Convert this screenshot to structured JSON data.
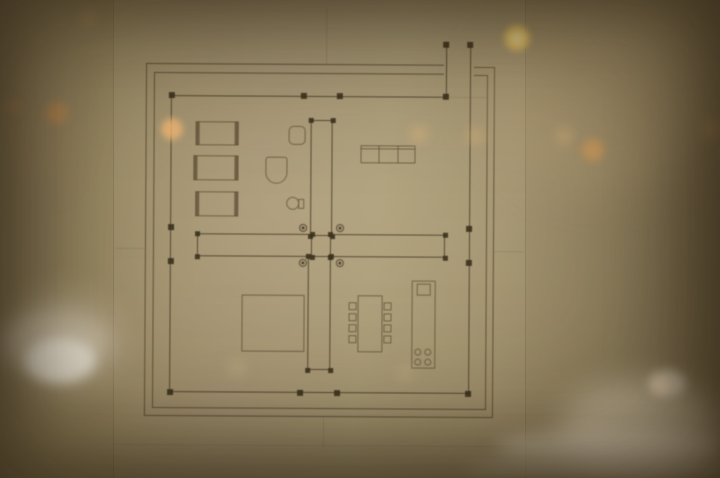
{
  "scene": {
    "subject": "architectural floor plan drawing framed behind reflective glass",
    "colors": {
      "frame": "rgba(78,64,42,0.82)",
      "wall": "rgba(62,52,32,0.85)",
      "column": "rgba(52,43,24,0.92)",
      "furn": "rgba(92,78,53,0.80)",
      "guide": "rgba(104,90,64,0.50)"
    }
  },
  "plan": {
    "frame": [
      {
        "type": "hline",
        "name": "frame-outer-top-left",
        "x": 145,
        "y": 64,
        "w": 298,
        "t": 1.4
      },
      {
        "type": "hline",
        "name": "frame-outer-top-right",
        "x": 473,
        "y": 66,
        "w": 21,
        "t": 1.4
      },
      {
        "type": "vline",
        "name": "frame-outer-right",
        "x": 493,
        "y": 66,
        "h": 351,
        "t": 1.4
      },
      {
        "type": "hline",
        "name": "frame-outer-bottom",
        "x": 145,
        "y": 416,
        "w": 349,
        "t": 1.4
      },
      {
        "type": "vline",
        "name": "frame-outer-left",
        "x": 145,
        "y": 64,
        "h": 353,
        "t": 1.4
      },
      {
        "type": "hline",
        "name": "frame-inner-top-left",
        "x": 153,
        "y": 73,
        "w": 290
      },
      {
        "type": "hline",
        "name": "frame-inner-top-right",
        "x": 473,
        "y": 74,
        "w": 13
      },
      {
        "type": "vline",
        "name": "frame-inner-right",
        "x": 486,
        "y": 74,
        "h": 335
      },
      {
        "type": "hline",
        "name": "frame-inner-bottom",
        "x": 153,
        "y": 408,
        "w": 334
      },
      {
        "type": "vline",
        "name": "frame-inner-left",
        "x": 153,
        "y": 73,
        "h": 336
      }
    ],
    "guides": [
      {
        "type": "vline",
        "name": "center-axis-guide-top",
        "x": 325,
        "y": 8,
        "h": 56,
        "t": 1,
        "o": 0.55
      },
      {
        "type": "vline",
        "name": "center-axis-guide-bottom",
        "x": 324,
        "y": 417,
        "h": 31,
        "t": 1,
        "o": 0.5
      },
      {
        "type": "hline",
        "name": "center-axis-guide-left",
        "x": 115,
        "y": 249,
        "w": 31,
        "t": 1,
        "o": 0.5
      },
      {
        "type": "hline",
        "name": "center-axis-guide-right",
        "x": 494,
        "y": 250,
        "w": 30,
        "t": 1,
        "o": 0.5
      },
      {
        "type": "hline",
        "name": "top-wall-guide-extension",
        "x": 448,
        "y": 96,
        "w": 38,
        "t": 1,
        "o": 0.4
      },
      {
        "type": "hline",
        "name": "sheet-bottom-edge",
        "x": 113,
        "y": 445,
        "w": 411,
        "t": 1,
        "o": 0.35
      }
    ],
    "walls": [
      {
        "type": "hline",
        "name": "top-exterior-wall",
        "x": 171,
        "y": 95.5,
        "w": 275,
        "t": 1.3
      },
      {
        "type": "vline",
        "name": "left-exterior-wall",
        "x": 170,
        "y": 96,
        "h": 297,
        "t": 1.3
      },
      {
        "type": "hline",
        "name": "bottom-exterior-wall",
        "x": 171,
        "y": 392,
        "w": 298,
        "t": 1.3
      },
      {
        "type": "vline",
        "name": "right-exterior-wall",
        "x": 469,
        "y": 44,
        "h": 349,
        "t": 1.3
      },
      {
        "type": "vline",
        "name": "court-extension-wall",
        "x": 445,
        "y": 44,
        "h": 52,
        "t": 1.3
      }
    ],
    "wall_boxes": [
      {
        "type": "rect",
        "name": "pinwheel-wall-north",
        "x": 310,
        "y": 120,
        "w": 22,
        "h": 116
      },
      {
        "type": "rect",
        "name": "pinwheel-wall-south",
        "x": 308,
        "y": 256,
        "w": 23,
        "h": 114
      },
      {
        "type": "rect",
        "name": "pinwheel-wall-west",
        "x": 197,
        "y": 234,
        "w": 115,
        "h": 23
      },
      {
        "type": "rect",
        "name": "pinwheel-wall-east",
        "x": 330,
        "y": 234,
        "w": 115,
        "h": 23
      }
    ],
    "square_columns": [
      {
        "name": "column",
        "x": 171,
        "y": 96,
        "s": 6
      },
      {
        "name": "column",
        "x": 303,
        "y": 96,
        "s": 6
      },
      {
        "name": "column",
        "x": 339,
        "y": 96,
        "s": 6
      },
      {
        "name": "column",
        "x": 445,
        "y": 96,
        "s": 6
      },
      {
        "name": "column",
        "x": 171,
        "y": 228,
        "s": 6
      },
      {
        "name": "column",
        "x": 171,
        "y": 262,
        "s": 6
      },
      {
        "name": "column",
        "x": 171,
        "y": 393,
        "s": 6
      },
      {
        "name": "column",
        "x": 469,
        "y": 228,
        "s": 6
      },
      {
        "name": "column",
        "x": 469,
        "y": 262,
        "s": 6
      },
      {
        "name": "column",
        "x": 469,
        "y": 393,
        "s": 6
      },
      {
        "name": "column",
        "x": 301,
        "y": 393,
        "s": 6
      },
      {
        "name": "column",
        "x": 338,
        "y": 393,
        "s": 6
      },
      {
        "name": "column",
        "x": 445,
        "y": 44,
        "s": 6
      },
      {
        "name": "column",
        "x": 469,
        "y": 44,
        "s": 6
      },
      {
        "name": "wall-end-pier",
        "x": 310,
        "y": 120,
        "s": 5
      },
      {
        "name": "wall-end-pier",
        "x": 332,
        "y": 120,
        "s": 5
      },
      {
        "name": "wall-end-pier",
        "x": 310,
        "y": 236,
        "s": 5
      },
      {
        "name": "wall-end-pier",
        "x": 332,
        "y": 236,
        "s": 5
      },
      {
        "name": "wall-end-pier",
        "x": 308,
        "y": 256,
        "s": 5
      },
      {
        "name": "wall-end-pier",
        "x": 331,
        "y": 256,
        "s": 5
      },
      {
        "name": "wall-end-pier",
        "x": 308,
        "y": 370,
        "s": 5
      },
      {
        "name": "wall-end-pier",
        "x": 331,
        "y": 370,
        "s": 5
      },
      {
        "name": "wall-end-pier",
        "x": 197,
        "y": 234,
        "s": 5
      },
      {
        "name": "wall-end-pier",
        "x": 312,
        "y": 234,
        "s": 5
      },
      {
        "name": "wall-end-pier",
        "x": 197,
        "y": 257,
        "s": 5
      },
      {
        "name": "wall-end-pier",
        "x": 312,
        "y": 257,
        "s": 5
      },
      {
        "name": "wall-end-pier",
        "x": 330,
        "y": 234,
        "s": 5
      },
      {
        "name": "wall-end-pier",
        "x": 445,
        "y": 234,
        "s": 5
      },
      {
        "name": "wall-end-pier",
        "x": 330,
        "y": 257,
        "s": 5
      },
      {
        "name": "wall-end-pier",
        "x": 445,
        "y": 257,
        "s": 5
      }
    ],
    "round_columns": [
      {
        "name": "round-column",
        "x": 303,
        "y": 228
      },
      {
        "name": "round-column",
        "x": 340,
        "y": 228
      },
      {
        "name": "round-column",
        "x": 303,
        "y": 263
      },
      {
        "name": "round-column",
        "x": 340,
        "y": 263
      }
    ],
    "furniture": [
      {
        "type": "rect",
        "name": "bed-1",
        "x": 195,
        "y": 122,
        "w": 43,
        "h": 24
      },
      {
        "type": "bar",
        "name": "bed-1-headboard",
        "x": 195,
        "y": 122,
        "w": 4,
        "h": 24
      },
      {
        "type": "bar",
        "name": "bed-1-footboard",
        "x": 234,
        "y": 122,
        "w": 4,
        "h": 24
      },
      {
        "type": "rect",
        "name": "bed-2",
        "x": 193,
        "y": 156,
        "w": 45,
        "h": 25
      },
      {
        "type": "bar",
        "name": "bed-2-headboard",
        "x": 193,
        "y": 156,
        "w": 4,
        "h": 25
      },
      {
        "type": "bar",
        "name": "bed-2-footboard",
        "x": 234,
        "y": 156,
        "w": 4,
        "h": 25
      },
      {
        "type": "rect",
        "name": "bed-3",
        "x": 195,
        "y": 192,
        "w": 43,
        "h": 25
      },
      {
        "type": "bar",
        "name": "bed-3-headboard",
        "x": 195,
        "y": 192,
        "w": 4,
        "h": 25
      },
      {
        "type": "bar",
        "name": "bed-3-footboard",
        "x": 234,
        "y": 192,
        "w": 4,
        "h": 25
      },
      {
        "type": "basin",
        "name": "washbasin",
        "x": 288,
        "y": 126,
        "w": 17,
        "h": 19
      },
      {
        "type": "tub",
        "name": "bathtub",
        "x": 265,
        "y": 157,
        "w": 22,
        "h": 27
      },
      {
        "type": "circle",
        "name": "toilet-bowl",
        "x": 286,
        "y": 197,
        "d": 13
      },
      {
        "type": "rect",
        "name": "toilet-tank",
        "x": 298,
        "y": 199,
        "w": 6,
        "h": 10
      },
      {
        "type": "rect",
        "name": "kitchen-counter",
        "x": 360,
        "y": 145,
        "w": 55,
        "h": 18
      },
      {
        "type": "hline",
        "name": "kitchen-counter-edge",
        "x": 360,
        "y": 148,
        "w": 55,
        "t": 1
      },
      {
        "type": "vline",
        "name": "kitchen-counter-divider",
        "x": 378,
        "y": 145,
        "h": 18,
        "t": 1
      },
      {
        "type": "vline",
        "name": "kitchen-counter-divider",
        "x": 397,
        "y": 145,
        "h": 18,
        "t": 1
      },
      {
        "type": "rect",
        "name": "patio-square",
        "x": 242,
        "y": 295,
        "w": 63,
        "h": 57
      },
      {
        "type": "rect",
        "name": "dining-table",
        "x": 358,
        "y": 295,
        "w": 25,
        "h": 57
      },
      {
        "type": "rect",
        "name": "chair",
        "x": 349,
        "y": 302,
        "w": 8,
        "h": 8
      },
      {
        "type": "rect",
        "name": "chair",
        "x": 349,
        "y": 313,
        "w": 8,
        "h": 8
      },
      {
        "type": "rect",
        "name": "chair",
        "x": 349,
        "y": 324,
        "w": 8,
        "h": 8
      },
      {
        "type": "rect",
        "name": "chair",
        "x": 349,
        "y": 335,
        "w": 8,
        "h": 8
      },
      {
        "type": "rect",
        "name": "chair",
        "x": 384,
        "y": 302,
        "w": 8,
        "h": 8
      },
      {
        "type": "rect",
        "name": "chair",
        "x": 384,
        "y": 313,
        "w": 8,
        "h": 8
      },
      {
        "type": "rect",
        "name": "chair",
        "x": 384,
        "y": 324,
        "w": 8,
        "h": 8
      },
      {
        "type": "rect",
        "name": "chair",
        "x": 384,
        "y": 335,
        "w": 8,
        "h": 8
      },
      {
        "type": "rect",
        "name": "kitchen-island",
        "x": 412,
        "y": 280,
        "w": 24,
        "h": 88
      },
      {
        "type": "rect",
        "name": "island-sink",
        "x": 417,
        "y": 283,
        "w": 14,
        "h": 12
      },
      {
        "type": "circle",
        "name": "stove-burner",
        "x": 415,
        "y": 348,
        "d": 7
      },
      {
        "type": "circle",
        "name": "stove-burner",
        "x": 425,
        "y": 348,
        "d": 7
      },
      {
        "type": "circle",
        "name": "stove-burner",
        "x": 415,
        "y": 358,
        "d": 7
      },
      {
        "type": "circle",
        "name": "stove-burner",
        "x": 425,
        "y": 358,
        "d": 7
      }
    ]
  },
  "photo": {
    "bokeh": [
      {
        "name": "bokeh-light",
        "cx": 57,
        "cy": 113,
        "r": 13,
        "color": "rgba(216,140,70,0.50)",
        "blur": 4
      },
      {
        "name": "bokeh-light",
        "cx": 14,
        "cy": 106,
        "r": 9,
        "color": "rgba(200,130,70,0.35)",
        "blur": 4
      },
      {
        "name": "bokeh-light",
        "cx": 88,
        "cy": 18,
        "r": 10,
        "color": "rgba(210,160,100,0.30)",
        "blur": 5
      },
      {
        "name": "bokeh-light",
        "cx": 172,
        "cy": 129,
        "r": 13,
        "color": "rgba(245,185,118,0.80)",
        "blur": 3
      },
      {
        "name": "bokeh-light",
        "cx": 517,
        "cy": 38,
        "r": 15,
        "color": "rgba(244,205,96,0.95)",
        "blur": 3,
        "core": "rgba(253,240,180,0.95)"
      },
      {
        "name": "bokeh-light",
        "cx": 593,
        "cy": 150,
        "r": 13,
        "color": "rgba(224,152,72,0.60)",
        "blur": 4
      },
      {
        "name": "bokeh-light",
        "cx": 712,
        "cy": 129,
        "r": 11,
        "color": "rgba(200,140,80,0.40)",
        "blur": 5
      },
      {
        "name": "bokeh-light",
        "cx": 419,
        "cy": 134,
        "r": 11,
        "color": "rgba(228,184,124,0.38)",
        "blur": 5
      },
      {
        "name": "bokeh-light",
        "cx": 475,
        "cy": 136,
        "r": 11,
        "color": "rgba(228,184,124,0.32)",
        "blur": 5
      },
      {
        "name": "bokeh-light",
        "cx": 564,
        "cy": 136,
        "r": 11,
        "color": "rgba(228,184,124,0.32)",
        "blur": 5
      },
      {
        "name": "bokeh-light",
        "cx": 661,
        "cy": 386,
        "r": 10,
        "color": "rgba(230,160,90,0.50)",
        "blur": 4
      },
      {
        "name": "bokeh-light",
        "cx": 237,
        "cy": 368,
        "r": 11,
        "color": "rgba(222,192,142,0.28)",
        "blur": 6
      },
      {
        "name": "bokeh-light",
        "cx": 405,
        "cy": 373,
        "r": 10,
        "color": "rgba(222,192,142,0.28)",
        "blur": 6
      }
    ],
    "reflections": [
      {
        "name": "reflection-haze-top-right",
        "x": 480,
        "y": 0,
        "w": 240,
        "h": 190,
        "color": "rgba(190,165,125,0.22)",
        "blur": 22
      },
      {
        "name": "reflection-haze-left",
        "x": 0,
        "y": 55,
        "w": 70,
        "h": 130,
        "color": "rgba(185,152,112,0.18)",
        "blur": 18
      },
      {
        "name": "reflection-object-halo",
        "x": 0,
        "y": 290,
        "w": 125,
        "h": 105,
        "color": "rgba(215,203,180,0.32)",
        "blur": 14
      },
      {
        "name": "reflection-white-object",
        "x": 2,
        "y": 312,
        "w": 105,
        "h": 62,
        "color": "rgba(226,216,198,0.55)",
        "blur": 10
      },
      {
        "name": "reflection-white-object-core",
        "x": 25,
        "y": 338,
        "w": 70,
        "h": 45,
        "color": "rgba(243,237,225,0.85)",
        "blur": 6
      },
      {
        "name": "reflection-glow-bottom-right",
        "x": 560,
        "y": 382,
        "w": 165,
        "h": 98,
        "color": "rgba(234,222,198,0.50)",
        "blur": 16
      },
      {
        "name": "reflection-streak-bottom",
        "x": 495,
        "y": 431,
        "w": 230,
        "h": 34,
        "color": "rgba(240,230,210,0.55)",
        "blur": 9
      },
      {
        "name": "reflection-streak-bottom-2",
        "x": 468,
        "y": 456,
        "w": 262,
        "h": 24,
        "color": "rgba(225,212,190,0.45)",
        "blur": 8
      },
      {
        "name": "reflection-spot-small",
        "x": 648,
        "y": 370,
        "w": 38,
        "h": 27,
        "color": "rgba(238,228,210,0.55)",
        "blur": 5
      }
    ]
  }
}
